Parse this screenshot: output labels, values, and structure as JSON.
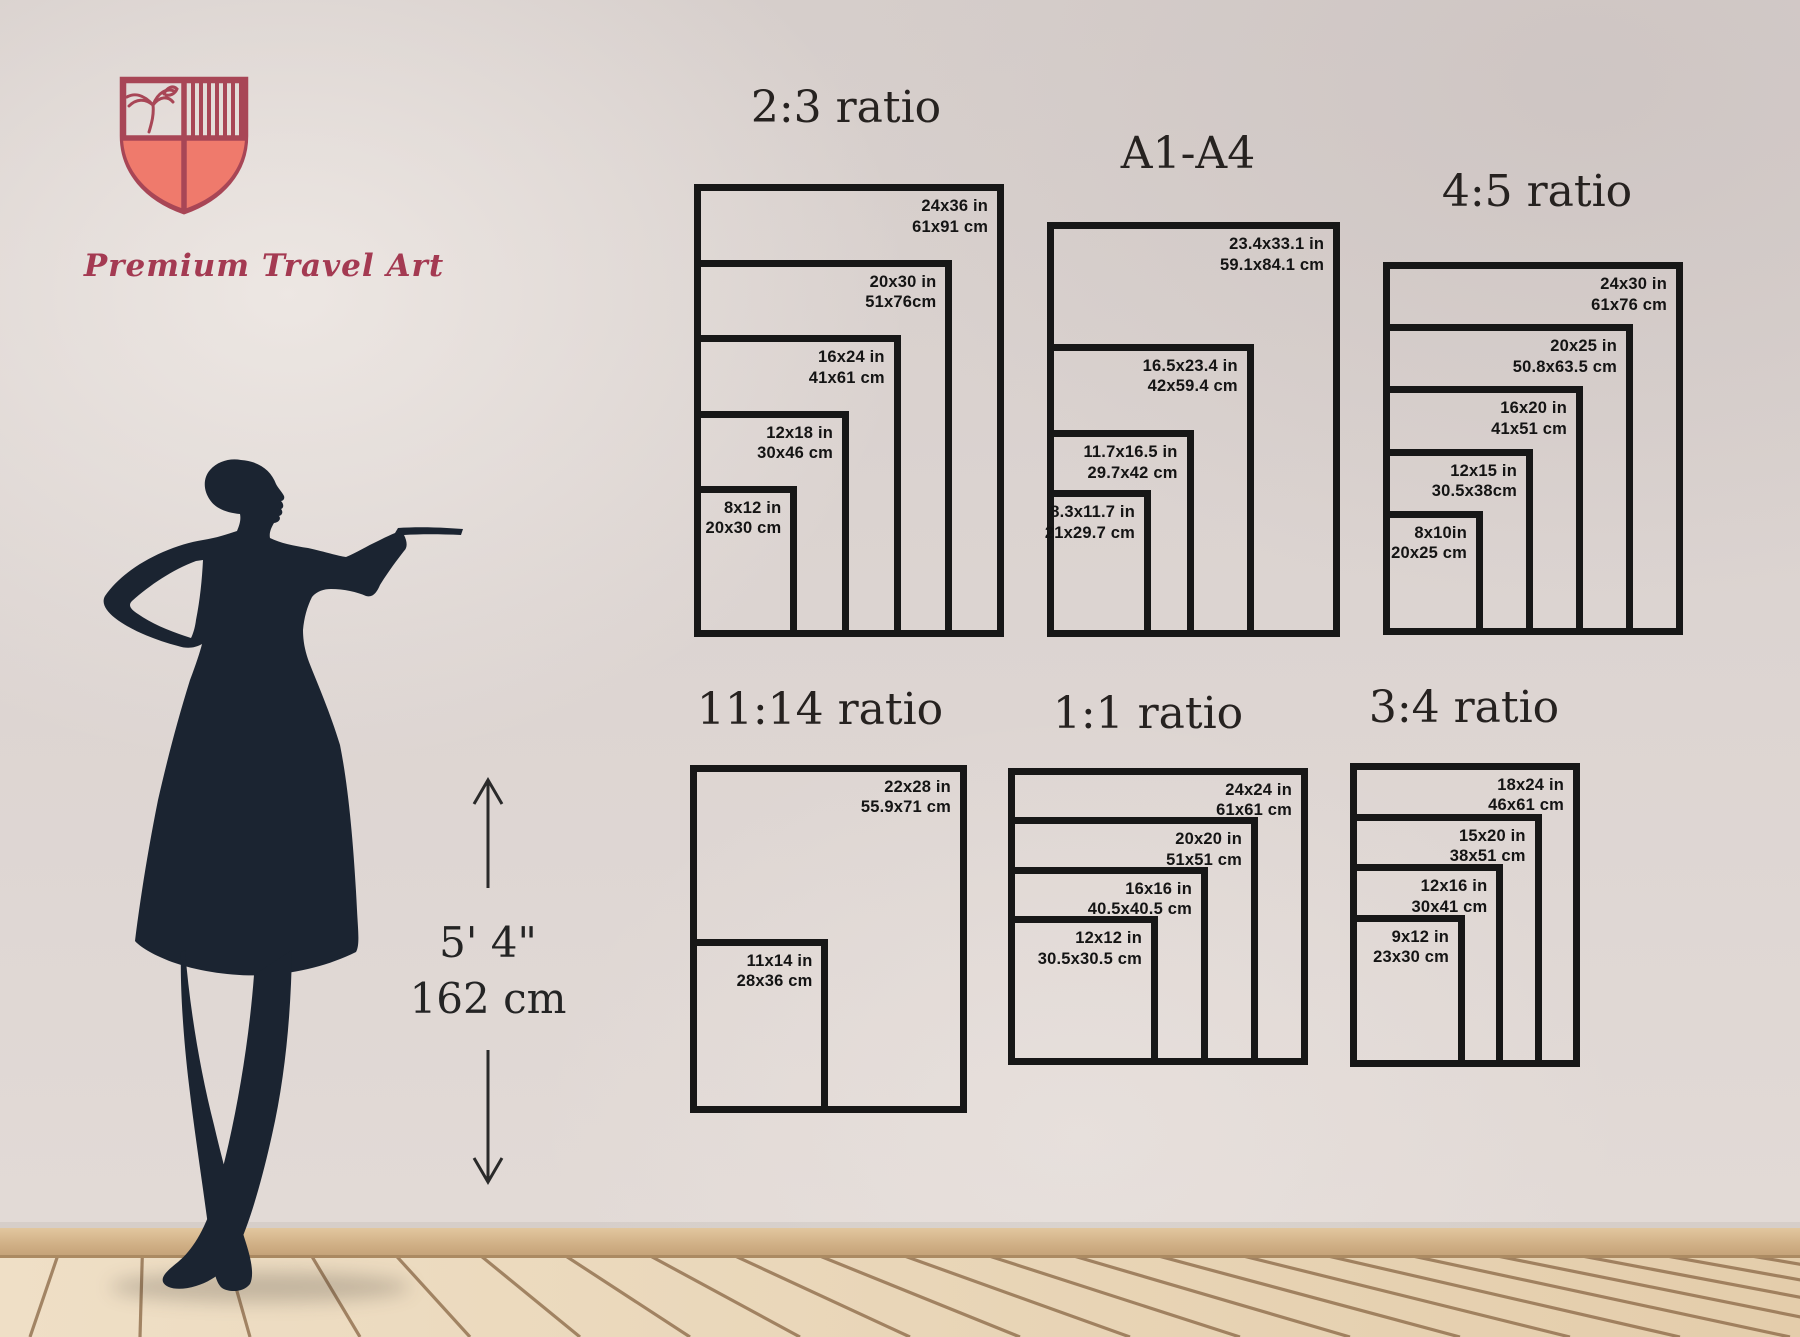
{
  "brand": {
    "name": "Premium Travel Art",
    "outline_color": "#a84656",
    "fill_color": "#ef7a6c"
  },
  "height_marker": {
    "imperial": "5' 4\"",
    "metric": "162 cm"
  },
  "palette": {
    "frame_border": "#171717",
    "label_text": "#141414",
    "title_text": "#262220",
    "silhouette": "#1b2431",
    "baseboard": "#cfae84",
    "floor": "#e9d6b8",
    "plank_gap": "#8d6b49"
  },
  "groups": [
    {
      "id": "ratio-2-3",
      "title": "2:3 ratio",
      "title_pos": {
        "x": 846,
        "y": 82
      },
      "anchor": {
        "left": 694,
        "bottom": 637
      },
      "scale": {
        "x": 12.92,
        "y": 12.58
      },
      "sizes": [
        {
          "w": 24,
          "h": 36,
          "in": "24x36 in",
          "cm": "61x91 cm"
        },
        {
          "w": 20,
          "h": 30,
          "in": "20x30 in",
          "cm": "51x76cm"
        },
        {
          "w": 16,
          "h": 24,
          "in": "16x24 in",
          "cm": "41x61 cm"
        },
        {
          "w": 12,
          "h": 18,
          "in": "12x18 in",
          "cm": "30x46 cm"
        },
        {
          "w": 8,
          "h": 12,
          "in": "8x12 in",
          "cm": "20x30 cm"
        }
      ]
    },
    {
      "id": "a-series",
      "title": "A1-A4",
      "title_pos": {
        "x": 1188,
        "y": 128
      },
      "anchor": {
        "left": 1047,
        "bottom": 637
      },
      "scale": {
        "x": 12.53,
        "y": 12.53
      },
      "sizes": [
        {
          "w": 23.4,
          "h": 33.1,
          "in": "23.4x33.1 in",
          "cm": "59.1x84.1 cm"
        },
        {
          "w": 16.5,
          "h": 23.4,
          "in": "16.5x23.4 in",
          "cm": "42x59.4 cm"
        },
        {
          "w": 11.7,
          "h": 16.5,
          "in": "11.7x16.5 in",
          "cm": "29.7x42 cm"
        },
        {
          "w": 8.3,
          "h": 11.7,
          "in": "8.3x11.7 in",
          "cm": "21x29.7 cm"
        }
      ]
    },
    {
      "id": "ratio-4-5",
      "title": "4:5 ratio",
      "title_pos": {
        "x": 1537,
        "y": 166
      },
      "anchor": {
        "left": 1383,
        "bottom": 635
      },
      "scale": {
        "x": 12.5,
        "y": 12.43
      },
      "sizes": [
        {
          "w": 24,
          "h": 30,
          "in": "24x30 in",
          "cm": "61x76 cm"
        },
        {
          "w": 20,
          "h": 25,
          "in": "20x25 in",
          "cm": "50.8x63.5 cm"
        },
        {
          "w": 16,
          "h": 20,
          "in": "16x20 in",
          "cm": "41x51 cm"
        },
        {
          "w": 12,
          "h": 15,
          "in": "12x15 in",
          "cm": "30.5x38cm"
        },
        {
          "w": 8,
          "h": 10,
          "in": "8x10in",
          "cm": "20x25 cm"
        }
      ]
    },
    {
      "id": "ratio-11-14",
      "title": "11:14 ratio",
      "title_pos": {
        "x": 820,
        "y": 684
      },
      "anchor": {
        "left": 690,
        "bottom": 1113
      },
      "scale": {
        "x": 12.59,
        "y": 12.43
      },
      "sizes": [
        {
          "w": 22,
          "h": 28,
          "in": "22x28 in",
          "cm": "55.9x71 cm"
        },
        {
          "w": 11,
          "h": 14,
          "in": "11x14 in",
          "cm": "28x36 cm"
        }
      ]
    },
    {
      "id": "ratio-1-1",
      "title": "1:1 ratio",
      "title_pos": {
        "x": 1148,
        "y": 688
      },
      "anchor": {
        "left": 1008,
        "bottom": 1065
      },
      "scale": {
        "x": 12.5,
        "y": 12.38
      },
      "sizes": [
        {
          "w": 24,
          "h": 24,
          "in": "24x24 in",
          "cm": "61x61 cm"
        },
        {
          "w": 20,
          "h": 20,
          "in": "20x20 in",
          "cm": "51x51 cm"
        },
        {
          "w": 16,
          "h": 16,
          "in": "16x16 in",
          "cm": "40.5x40.5 cm"
        },
        {
          "w": 12,
          "h": 12,
          "in": "12x12 in",
          "cm": "30.5x30.5 cm"
        }
      ]
    },
    {
      "id": "ratio-3-4",
      "title": "3:4 ratio",
      "title_pos": {
        "x": 1464,
        "y": 682
      },
      "anchor": {
        "left": 1350,
        "bottom": 1067
      },
      "scale": {
        "x": 12.78,
        "y": 12.67
      },
      "sizes": [
        {
          "w": 18,
          "h": 24,
          "in": "18x24 in",
          "cm": "46x61 cm"
        },
        {
          "w": 15,
          "h": 20,
          "in": "15x20 in",
          "cm": "38x51 cm"
        },
        {
          "w": 12,
          "h": 16,
          "in": "12x16 in",
          "cm": "30x41 cm"
        },
        {
          "w": 9,
          "h": 12,
          "in": "9x12 in",
          "cm": "23x30 cm"
        }
      ]
    }
  ]
}
